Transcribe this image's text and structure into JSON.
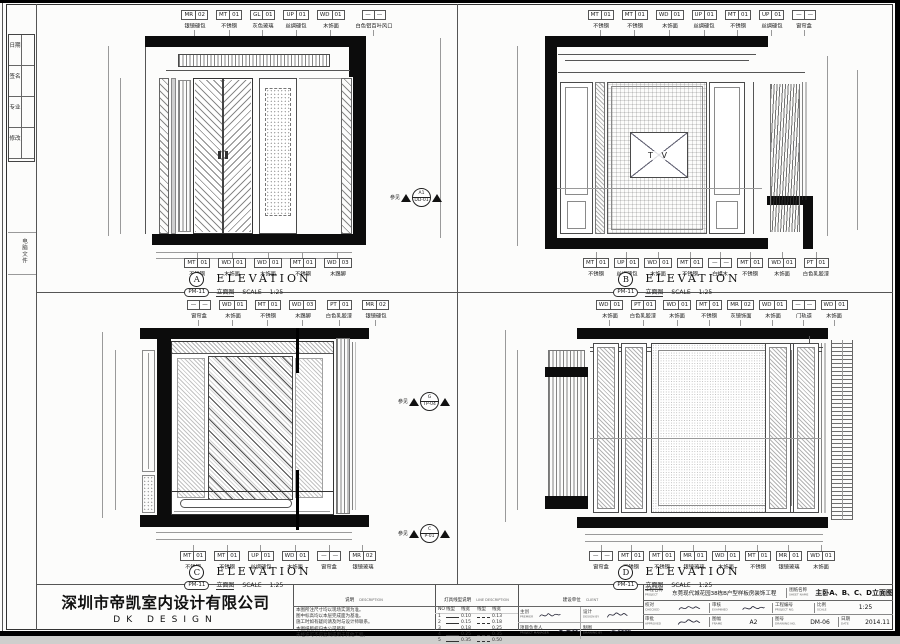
{
  "sheet": {
    "margin": {
      "revision_rows": [
        {
          "label": "日期"
        },
        {
          "label": "签名"
        },
        {
          "label": "专业"
        },
        {
          "label": "修改"
        }
      ],
      "file_note": "电脑文件"
    }
  },
  "elevations": [
    {
      "letter": "A",
      "title": "ELEVATION",
      "ref": "PM-11",
      "ref_zh": "立面图",
      "scale_label": "SCALE",
      "scale": "1:25",
      "see": {
        "label": "参见",
        "top": "A1",
        "bottom": "DD-01"
      },
      "top_callouts": [
        {
          "c": "MR",
          "n": "02",
          "l": "银镜硬包"
        },
        {
          "c": "MT",
          "n": "01",
          "l": "不锈钢"
        },
        {
          "c": "GL",
          "n": "01",
          "l": "灰色玻璃"
        },
        {
          "c": "UP",
          "n": "01",
          "l": "丝绸硬包"
        },
        {
          "c": "WD",
          "n": "01",
          "l": "木饰面"
        },
        {
          "c": "—",
          "n": "—",
          "l": "白色铝百叶风口"
        }
      ],
      "bottom_callouts": [
        {
          "c": "MT",
          "n": "01",
          "l": "不锈钢"
        },
        {
          "c": "WD",
          "n": "01",
          "l": "木饰面"
        },
        {
          "c": "WD",
          "n": "01",
          "l": "木饰面"
        },
        {
          "c": "MT",
          "n": "01",
          "l": "不锈钢"
        },
        {
          "c": "WD",
          "n": "03",
          "l": "木踢脚"
        }
      ]
    },
    {
      "letter": "B",
      "title": "ELEVATION",
      "ref": "PM-11",
      "ref_zh": "立面图",
      "scale_label": "SCALE",
      "scale": "1:25",
      "tv_label": "T V",
      "top_callouts": [
        {
          "c": "MT",
          "n": "01",
          "l": "不锈钢"
        },
        {
          "c": "MT",
          "n": "01",
          "l": "不锈钢"
        },
        {
          "c": "WD",
          "n": "01",
          "l": "木饰面"
        },
        {
          "c": "UP",
          "n": "01",
          "l": "丝绸硬包"
        },
        {
          "c": "MT",
          "n": "01",
          "l": "不锈钢"
        },
        {
          "c": "UP",
          "n": "01",
          "l": "丝绸硬包"
        },
        {
          "c": "—",
          "n": "—",
          "l": "窗帘盒"
        }
      ],
      "bottom_callouts": [
        {
          "c": "MT",
          "n": "01",
          "l": "不锈钢"
        },
        {
          "c": "UP",
          "n": "01",
          "l": "丝绸硬包"
        },
        {
          "c": "WD",
          "n": "01",
          "l": "木饰面"
        },
        {
          "c": "MT",
          "n": "01",
          "l": "不锈钢"
        },
        {
          "c": "—",
          "n": "—",
          "l": "白蜡木"
        },
        {
          "c": "MT",
          "n": "01",
          "l": "不锈钢"
        },
        {
          "c": "WD",
          "n": "01",
          "l": "木饰面"
        },
        {
          "c": "PT",
          "n": "01",
          "l": "白色乳胶漆"
        }
      ]
    },
    {
      "letter": "C",
      "title": "ELEVATION",
      "ref": "PM-11",
      "ref_zh": "立面图",
      "scale_label": "SCALE",
      "scale": "1:25",
      "see1": {
        "label": "参见",
        "top": "G",
        "bottom": "TP-04"
      },
      "see2": {
        "label": "参见",
        "top": "C",
        "bottom": "P-01"
      },
      "top_callouts": [
        {
          "c": "—",
          "n": "—",
          "l": "窗帘盒"
        },
        {
          "c": "WD",
          "n": "01",
          "l": "木饰面"
        },
        {
          "c": "MT",
          "n": "01",
          "l": "不锈钢"
        },
        {
          "c": "WD",
          "n": "03",
          "l": "木踢脚"
        },
        {
          "c": "PT",
          "n": "01",
          "l": "白色乳胶漆"
        },
        {
          "c": "MR",
          "n": "02",
          "l": "银镜硬包"
        }
      ],
      "bottom_callouts": [
        {
          "c": "MT",
          "n": "01",
          "l": "不锈钢"
        },
        {
          "c": "MT",
          "n": "01",
          "l": "不锈钢"
        },
        {
          "c": "UP",
          "n": "01",
          "l": "丝绸硬包"
        },
        {
          "c": "WD",
          "n": "01",
          "l": "木饰面"
        },
        {
          "c": "—",
          "n": "—",
          "l": "窗帘盒"
        },
        {
          "c": "MR",
          "n": "02",
          "l": "银镜玻璃"
        }
      ]
    },
    {
      "letter": "D",
      "title": "ELEVATION",
      "ref": "PM-11",
      "ref_zh": "立面图",
      "scale_label": "SCALE",
      "scale": "1:25",
      "top_callouts": [
        {
          "c": "WD",
          "n": "01",
          "l": "木饰面"
        },
        {
          "c": "PT",
          "n": "01",
          "l": "白色乳胶漆"
        },
        {
          "c": "WD",
          "n": "01",
          "l": "木饰面"
        },
        {
          "c": "MT",
          "n": "01",
          "l": "不锈钢"
        },
        {
          "c": "MR",
          "n": "02",
          "l": "灰镜饰面"
        },
        {
          "c": "WD",
          "n": "01",
          "l": "木饰面"
        },
        {
          "c": "—",
          "n": "—",
          "l": "门轨道"
        },
        {
          "c": "WD",
          "n": "01",
          "l": "木饰面"
        }
      ],
      "bottom_callouts": [
        {
          "c": "—",
          "n": "—",
          "l": "窗帘盒"
        },
        {
          "c": "MT",
          "n": "01",
          "l": "不锈钢"
        },
        {
          "c": "MT",
          "n": "01",
          "l": "不锈钢"
        },
        {
          "c": "MR",
          "n": "01",
          "l": "银镜玻璃"
        },
        {
          "c": "WD",
          "n": "01",
          "l": "木饰面"
        },
        {
          "c": "MT",
          "n": "01",
          "l": "不锈钢"
        },
        {
          "c": "MR",
          "n": "01",
          "l": "银镜玻璃"
        },
        {
          "c": "WD",
          "n": "01",
          "l": "木饰面"
        }
      ]
    }
  ],
  "title_block": {
    "company": "深圳市帝凯室内设计有限公司",
    "brand": "DK DESIGN",
    "description": {
      "zh": "说明",
      "en": "DESCRIPTION",
      "lines": [
        {
          "t": "本图所注尺寸均以现场实测为准。"
        },
        {
          "t": "图中标高均以本层完成面为基准。"
        },
        {
          "t": "施工时如有疑问请及时与设计师联系。"
        },
        {
          "t": "本图纸版权归本公司所有。"
        },
        {
          "t": "未经许可不得复制或用于其他工程。"
        }
      ]
    },
    "linetype": {
      "zh": "灯具线型说明",
      "en": "LINE DESCRIPTION",
      "cols": {
        "no": "NO",
        "line": "线型",
        "width": "线宽"
      },
      "rows": [
        {
          "no": "1",
          "w1": "0.10",
          "w2": "0.13"
        },
        {
          "no": "2",
          "w1": "0.15",
          "w2": "0.18"
        },
        {
          "no": "3",
          "w1": "0.18",
          "w2": "0.25"
        },
        {
          "no": "4",
          "w1": "0.25",
          "w2": "0.35"
        },
        {
          "no": "5",
          "w1": "0.35",
          "w2": "0.50"
        }
      ]
    },
    "client": {
      "zh": "建设单位",
      "en": "CLIENT"
    },
    "signers": {
      "premier": {
        "zh": "主创",
        "en": "PREMIER"
      },
      "pm": {
        "zh": "项目负责人",
        "en": "PROJECT MANAGER"
      },
      "design": {
        "zh": "设计",
        "en": "DESIGN BY"
      },
      "draft": {
        "zh": "制图",
        "en": "DRAWING BY"
      }
    },
    "fields": {
      "project": {
        "zh": "工程名称",
        "en": "PROJECT",
        "value": "东莞现代城花园38栋B户型样板房装饰工程"
      },
      "sheet": {
        "zh": "图纸名称",
        "en": "SHEET NAME",
        "value": "主卧A、B、C、D立面图"
      },
      "checked": {
        "zh": "校对",
        "en": "CHECKED"
      },
      "examined": {
        "zh": "审核",
        "en": "EXAMINED"
      },
      "approved": {
        "zh": "审批",
        "en": "APPROVED"
      },
      "project_no": {
        "zh": "工程编号",
        "en": "PROJECT NO."
      },
      "scale": {
        "zh": "比例",
        "en": "SCALE",
        "value": "1:25"
      },
      "frame": {
        "zh": "图幅",
        "en": "FRAME",
        "value": "A2"
      },
      "drawing_no": {
        "zh": "图号",
        "en": "DRAWING NO.",
        "value": "DM-06"
      },
      "date": {
        "zh": "日期",
        "en": "DATE",
        "value": "2014.11"
      }
    }
  }
}
